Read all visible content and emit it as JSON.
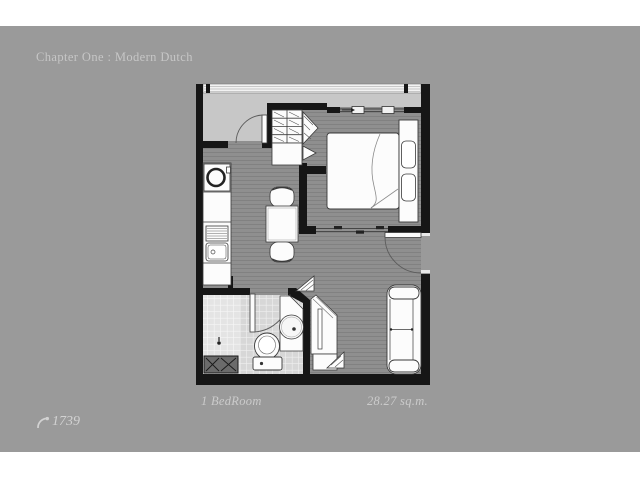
{
  "page": {
    "header_title": "Chapter One : Modern Dutch",
    "captions": {
      "room_type": "1 BedRoom",
      "area": "28.27 sq.m."
    },
    "footer": {
      "views_icon": "curved-arrow-icon",
      "views_count": "1739"
    },
    "colors": {
      "photo_background": "#9a9a9a",
      "page_band": "#ffffff",
      "wall": "#161616",
      "floor": "#8f8f8f",
      "balcony": "#c7c7c7",
      "bathroom_tile": "#d7d7d7",
      "shower_tile": "#e3e3e3",
      "furniture": "#fcfcfc",
      "text": "#c9c9c9"
    }
  }
}
